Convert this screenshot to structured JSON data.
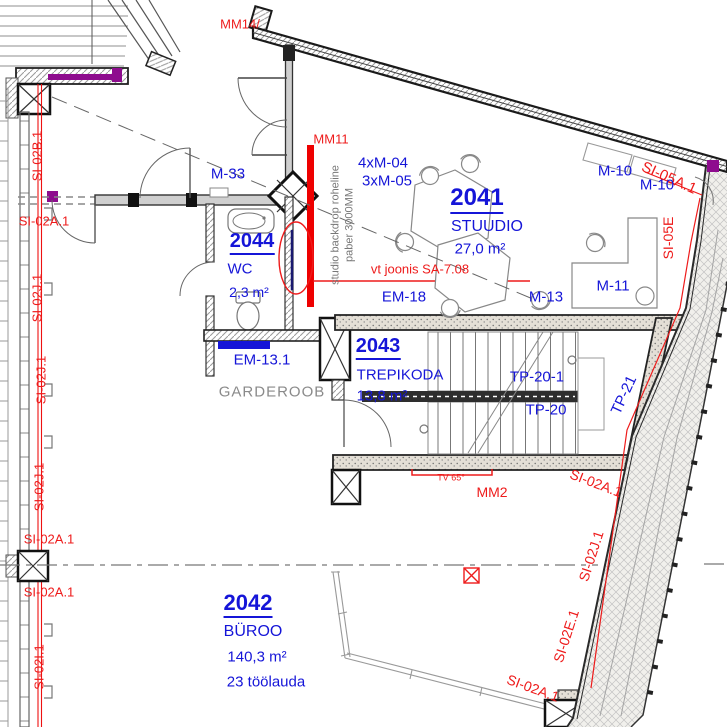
{
  "drawing": {
    "rooms": {
      "studio": {
        "number": "2041",
        "name": "STUUDIO",
        "area": "27,0 m²"
      },
      "office": {
        "number": "2042",
        "name": "BÜROO",
        "area": "140,3 m²",
        "workstations": "23 töölauda"
      },
      "stairwell": {
        "number": "2043",
        "name": "TREPIKODA",
        "area": "13,8 m²"
      },
      "wc": {
        "number": "2044",
        "name": "WC",
        "area": "2,3 m²",
        "code": "ET-02"
      }
    },
    "labels": {
      "mm14": "MM14/",
      "mm11": "MM11",
      "mm2": "MM2",
      "m33": "M-33",
      "m04": "4xM-04",
      "m05": "3xM-05",
      "m10": "M-10",
      "m11": "M-11",
      "m13": "M-13",
      "em18": "EM-18",
      "em131": "EM-13.1",
      "tp201": "TP-20-1",
      "tp20": "TP-20",
      "tp21": "TP-21",
      "tv65": "TV 65°",
      "vt_joonis": "vt joonis SA-7.08",
      "garderoob": "GARDEROOB",
      "backdrop_line1": "studio backdrop roheline",
      "backdrop_line2": "paber 3000MM",
      "si05a": "SI-05A.1",
      "si05e": "SI-05E",
      "si02a1": "SI-02A.1",
      "si02b1": "SI-02B.1",
      "si02j1": "SI-02J.1",
      "si02i1": "SI-02I.1",
      "si02e1": "SI-02E.1"
    },
    "colors": {
      "label_blue": "#1515d8",
      "annotation_red": "#ee1b1b",
      "backdrop_red": "#ee0000",
      "magenta": "#8e0c8e",
      "navy_highlight": "#191970",
      "text_gray": "#8a8a8a"
    }
  }
}
